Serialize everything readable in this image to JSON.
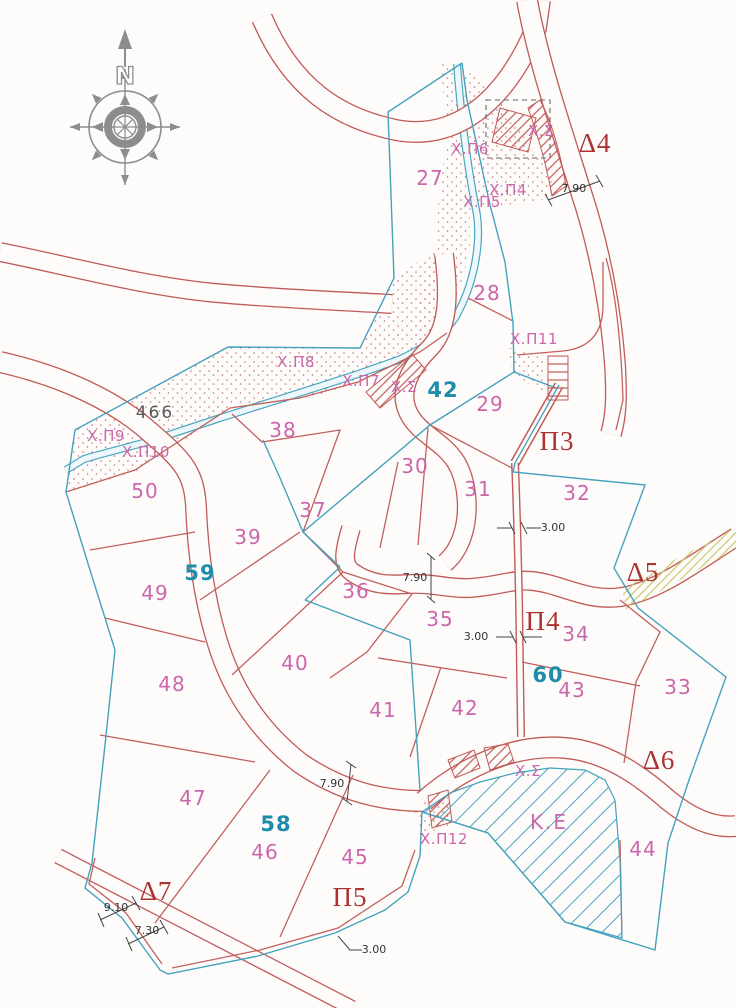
{
  "map": {
    "compass_north": "N",
    "colors": {
      "parcel_line_red": "#c2605d",
      "road_red": "#c05a57",
      "boundary_cyan": "#45a2bd",
      "label_magenta": "#ca67ab",
      "block_teal": "#1d8dab",
      "district_red": "#ab3331",
      "dimension_black": "#333333",
      "stipple_dot": "#c4706e",
      "hatch_yellow": "#cbcb72",
      "compass_gray": "#8d8d8d"
    },
    "labels": [
      {
        "text": "27",
        "x": 430,
        "y": 185,
        "type": "parcel"
      },
      {
        "text": "28",
        "x": 487,
        "y": 300,
        "type": "parcel"
      },
      {
        "text": "29",
        "x": 490,
        "y": 411,
        "type": "parcel"
      },
      {
        "text": "30",
        "x": 415,
        "y": 473,
        "type": "parcel"
      },
      {
        "text": "31",
        "x": 478,
        "y": 496,
        "type": "parcel"
      },
      {
        "text": "32",
        "x": 577,
        "y": 500,
        "type": "parcel"
      },
      {
        "text": "33",
        "x": 678,
        "y": 694,
        "type": "parcel"
      },
      {
        "text": "34",
        "x": 576,
        "y": 641,
        "type": "parcel"
      },
      {
        "text": "35",
        "x": 440,
        "y": 626,
        "type": "parcel"
      },
      {
        "text": "36",
        "x": 356,
        "y": 598,
        "type": "parcel"
      },
      {
        "text": "37",
        "x": 313,
        "y": 517,
        "type": "parcel"
      },
      {
        "text": "38",
        "x": 283,
        "y": 437,
        "type": "parcel"
      },
      {
        "text": "39",
        "x": 248,
        "y": 544,
        "type": "parcel"
      },
      {
        "text": "40",
        "x": 295,
        "y": 670,
        "type": "parcel"
      },
      {
        "text": "41",
        "x": 383,
        "y": 717,
        "type": "parcel"
      },
      {
        "text": "42",
        "x": 465,
        "y": 715,
        "type": "parcel"
      },
      {
        "text": "43",
        "x": 572,
        "y": 697,
        "type": "parcel"
      },
      {
        "text": "44",
        "x": 643,
        "y": 856,
        "type": "parcel"
      },
      {
        "text": "45",
        "x": 355,
        "y": 864,
        "type": "parcel"
      },
      {
        "text": "46",
        "x": 265,
        "y": 859,
        "type": "parcel"
      },
      {
        "text": "47",
        "x": 193,
        "y": 805,
        "type": "parcel"
      },
      {
        "text": "48",
        "x": 172,
        "y": 691,
        "type": "parcel"
      },
      {
        "text": "49",
        "x": 155,
        "y": 600,
        "type": "parcel"
      },
      {
        "text": "50",
        "x": 145,
        "y": 498,
        "type": "parcel"
      },
      {
        "text": "42",
        "x": 443,
        "y": 397,
        "type": "block"
      },
      {
        "text": "58",
        "x": 276,
        "y": 831,
        "type": "block"
      },
      {
        "text": "59",
        "x": 200,
        "y": 580,
        "type": "block"
      },
      {
        "text": "60",
        "x": 548,
        "y": 682,
        "type": "block"
      },
      {
        "text": "466",
        "x": 155,
        "y": 418,
        "type": "ref"
      },
      {
        "text": "Χ.Π4",
        "x": 508,
        "y": 195,
        "type": "landmark"
      },
      {
        "text": "Χ.Π5",
        "x": 482,
        "y": 207,
        "type": "landmark"
      },
      {
        "text": "Χ.Π6",
        "x": 470,
        "y": 154,
        "type": "landmark"
      },
      {
        "text": "Χ.Σ",
        "x": 541,
        "y": 136,
        "type": "landmark"
      },
      {
        "text": "Χ.Π7",
        "x": 361,
        "y": 386,
        "type": "landmark"
      },
      {
        "text": "Χ.Σ",
        "x": 404,
        "y": 392,
        "type": "landmark"
      },
      {
        "text": "Χ.Π8",
        "x": 296,
        "y": 367,
        "type": "landmark"
      },
      {
        "text": "Χ.Π9",
        "x": 106,
        "y": 441,
        "type": "landmark"
      },
      {
        "text": "Χ.Π10",
        "x": 146,
        "y": 457,
        "type": "landmark"
      },
      {
        "text": "Χ.Π11",
        "x": 534,
        "y": 344,
        "type": "landmark"
      },
      {
        "text": "Χ.Π12",
        "x": 444,
        "y": 844,
        "type": "landmark"
      },
      {
        "text": "Χ.Σ",
        "x": 528,
        "y": 776,
        "type": "landmark"
      },
      {
        "text": "Κ.Ε",
        "x": 549,
        "y": 829,
        "type": "area"
      },
      {
        "text": "Δ4",
        "x": 595,
        "y": 152,
        "type": "district"
      },
      {
        "text": "Δ5",
        "x": 643,
        "y": 581,
        "type": "district"
      },
      {
        "text": "Δ6",
        "x": 659,
        "y": 769,
        "type": "district"
      },
      {
        "text": "Δ7",
        "x": 156,
        "y": 900,
        "type": "district"
      },
      {
        "text": "Π3",
        "x": 557,
        "y": 450,
        "type": "district"
      },
      {
        "text": "Π4",
        "x": 543,
        "y": 630,
        "type": "district"
      },
      {
        "text": "Π5",
        "x": 350,
        "y": 906,
        "type": "district"
      },
      {
        "text": "7.90",
        "x": 574,
        "y": 192,
        "type": "dim"
      },
      {
        "text": "7.90",
        "x": 415,
        "y": 581,
        "type": "dim"
      },
      {
        "text": "7.90",
        "x": 332,
        "y": 787,
        "type": "dim"
      },
      {
        "text": "3.00",
        "x": 553,
        "y": 531,
        "type": "dim"
      },
      {
        "text": "3.00",
        "x": 476,
        "y": 640,
        "type": "dim"
      },
      {
        "text": "3.00",
        "x": 374,
        "y": 953,
        "type": "dim"
      },
      {
        "text": "9.10",
        "x": 116,
        "y": 911,
        "type": "dim"
      },
      {
        "text": "7.30",
        "x": 147,
        "y": 934,
        "type": "dim"
      }
    ]
  }
}
